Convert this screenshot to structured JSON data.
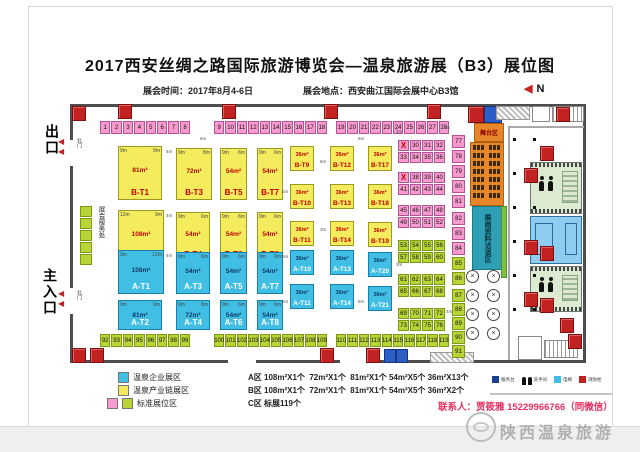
{
  "header": {
    "title": "2017西安丝绸之路国际旅游博览会—温泉旅游展（B3）展位图",
    "time_label": "展会时间：2017年8月4-6日",
    "place_label": "展会地点：西安曲江国际会展中心B3馆",
    "compass_n": "N"
  },
  "left": {
    "exit": "出口",
    "main_entrance": "主入口",
    "gate": "北门",
    "service_desk": "展会服务处"
  },
  "stage": {
    "label": "舞台区",
    "meeting_label": "展商资料洽谈区"
  },
  "booths": {
    "b_large": [
      {
        "name": "B-T1",
        "area": "81m²",
        "d1": "9m",
        "d2": "9m",
        "x": 118,
        "y": 146,
        "w": 44,
        "h": 54
      },
      {
        "name": "B-T3",
        "area": "72m²",
        "d1": "9m",
        "d2": "8m",
        "x": 176,
        "y": 148,
        "w": 36,
        "h": 52
      },
      {
        "name": "B-T5",
        "area": "54m²",
        "d1": "9m",
        "d2": "6m",
        "x": 220,
        "y": 148,
        "w": 27,
        "h": 52
      },
      {
        "name": "B-T7",
        "area": "54m²",
        "d1": "9m",
        "d2": "6m",
        "x": 257,
        "y": 148,
        "w": 26,
        "h": 52
      },
      {
        "name": "B-T2",
        "area": "108m²",
        "d1": "12m",
        "d2": "9m",
        "x": 118,
        "y": 210,
        "w": 46,
        "h": 54
      },
      {
        "name": "B-T4",
        "area": "54m²",
        "d1": "9m",
        "d2": "6m",
        "x": 176,
        "y": 212,
        "w": 34,
        "h": 50
      },
      {
        "name": "B-T6",
        "area": "54m²",
        "d1": "9m",
        "d2": "6m",
        "x": 220,
        "y": 212,
        "w": 27,
        "h": 50
      },
      {
        "name": "B-T8",
        "area": "54m²",
        "d1": "9m",
        "d2": "6m",
        "x": 257,
        "y": 212,
        "w": 26,
        "h": 50
      }
    ],
    "b_small": [
      {
        "name": "B-T9",
        "area": "36m²",
        "x": 290,
        "y": 146
      },
      {
        "name": "B-T12",
        "area": "36m²",
        "x": 330,
        "y": 146
      },
      {
        "name": "B-T17",
        "area": "36m²",
        "x": 368,
        "y": 146
      },
      {
        "name": "B-T10",
        "area": "36m²",
        "x": 290,
        "y": 184
      },
      {
        "name": "B-T13",
        "area": "36m²",
        "x": 330,
        "y": 184
      },
      {
        "name": "B-T18",
        "area": "36m²",
        "x": 368,
        "y": 184
      },
      {
        "name": "B-T11",
        "area": "36m²",
        "x": 290,
        "y": 221
      },
      {
        "name": "B-T14",
        "area": "36m²",
        "x": 330,
        "y": 221
      },
      {
        "name": "B-T19",
        "area": "36m²",
        "x": 368,
        "y": 222
      }
    ],
    "a_large": [
      {
        "name": "A-T1",
        "area": "108m²",
        "d1": "9m",
        "d2": "12m",
        "x": 118,
        "y": 250,
        "w": 46,
        "h": 44
      },
      {
        "name": "A-T3",
        "area": "54m²",
        "d1": "9m",
        "d2": "6m",
        "x": 176,
        "y": 252,
        "w": 34,
        "h": 42
      },
      {
        "name": "A-T5",
        "area": "54m²",
        "d1": "9m",
        "d2": "6m",
        "x": 220,
        "y": 252,
        "w": 27,
        "h": 42
      },
      {
        "name": "A-T7",
        "area": "54m²",
        "d1": "9m",
        "d2": "6m",
        "x": 257,
        "y": 252,
        "w": 26,
        "h": 42
      },
      {
        "name": "A-T2",
        "area": "81m²",
        "d1": "9m",
        "d2": "9m",
        "x": 118,
        "y": 300,
        "w": 44,
        "h": 30
      },
      {
        "name": "A-T4",
        "area": "72m²",
        "d1": "9m",
        "d2": "8m",
        "x": 176,
        "y": 300,
        "w": 34,
        "h": 30
      },
      {
        "name": "A-T6",
        "area": "54m²",
        "d1": "9m",
        "d2": "6m",
        "x": 220,
        "y": 300,
        "w": 27,
        "h": 30
      },
      {
        "name": "A-T8",
        "area": "54m²",
        "d1": "9m",
        "d2": "6m",
        "x": 257,
        "y": 300,
        "w": 26,
        "h": 30
      }
    ],
    "a_small": [
      {
        "name": "A-T10",
        "area": "36m²",
        "x": 290,
        "y": 250
      },
      {
        "name": "A-T13",
        "area": "36m²",
        "x": 330,
        "y": 250
      },
      {
        "name": "A-T20",
        "area": "36m²",
        "x": 368,
        "y": 252
      },
      {
        "name": "A-T11",
        "area": "36m²",
        "x": 290,
        "y": 284
      },
      {
        "name": "A-T14",
        "area": "36m²",
        "x": 330,
        "y": 284
      },
      {
        "name": "A-T21",
        "area": "36m²",
        "x": 368,
        "y": 286
      }
    ]
  },
  "std": {
    "top_groups": [
      {
        "start": 1,
        "count": 8,
        "x": 100
      },
      {
        "start": 9,
        "count": 10,
        "x": 214
      },
      {
        "start": 19,
        "count": 10,
        "x": 336
      }
    ],
    "bottom_groups": [
      {
        "start": 92,
        "count": 8,
        "x": 100
      },
      {
        "start": 100,
        "count": 10,
        "x": 214
      },
      {
        "start": 110,
        "count": 10,
        "x": 336
      }
    ],
    "grid": {
      "x": 398,
      "rows": [
        {
          "y": 140,
          "cells": [
            "X",
            "30",
            "31",
            "32"
          ]
        },
        {
          "y": 152,
          "cells": [
            "33",
            "34",
            "35",
            "36"
          ]
        },
        {
          "y": 172,
          "cells": [
            "X",
            "38",
            "39",
            "40"
          ]
        },
        {
          "y": 184,
          "cells": [
            "41",
            "42",
            "43",
            "44"
          ]
        },
        {
          "y": 205,
          "cells": [
            "45",
            "46",
            "47",
            "48"
          ]
        },
        {
          "y": 217,
          "cells": [
            "49",
            "50",
            "51",
            "52"
          ]
        },
        {
          "y": 240,
          "cells": [
            "53",
            "54",
            "55",
            "56"
          ],
          "g": true
        },
        {
          "y": 252,
          "cells": [
            "57",
            "58",
            "59",
            "60"
          ],
          "g": true
        },
        {
          "y": 274,
          "cells": [
            "61",
            "62",
            "63",
            "64"
          ],
          "g": true
        },
        {
          "y": 286,
          "cells": [
            "65",
            "66",
            "67",
            "68"
          ],
          "g": true
        },
        {
          "y": 308,
          "cells": [
            "69",
            "70",
            "71",
            "72"
          ],
          "g": true
        },
        {
          "y": 320,
          "cells": [
            "73",
            "74",
            "75",
            "76"
          ],
          "g": true
        }
      ]
    },
    "side_strip": [
      {
        "n": "77",
        "y": 135
      },
      {
        "n": "78",
        "y": 150
      },
      {
        "n": "79",
        "y": 165
      },
      {
        "n": "80",
        "y": 180
      },
      {
        "n": "81",
        "y": 195
      },
      {
        "n": "82",
        "y": 212
      },
      {
        "n": "83",
        "y": 227
      },
      {
        "n": "84",
        "y": 242
      },
      {
        "n": "85",
        "y": 257,
        "g": true
      },
      {
        "n": "86",
        "y": 272,
        "g": true
      },
      {
        "n": "87",
        "y": 289,
        "g": true
      },
      {
        "n": "88",
        "y": 303,
        "g": true
      },
      {
        "n": "89",
        "y": 317,
        "g": true
      },
      {
        "n": "90",
        "y": 331,
        "g": true
      },
      {
        "n": "91",
        "y": 345,
        "g": true
      }
    ]
  },
  "dims": [
    {
      "t": "4m",
      "x": 166,
      "y": 150
    },
    {
      "t": "4m",
      "x": 166,
      "y": 214
    },
    {
      "t": "4m",
      "x": 166,
      "y": 254
    },
    {
      "t": "6m",
      "x": 200,
      "y": 137
    },
    {
      "t": "6m",
      "x": 358,
      "y": 137
    },
    {
      "t": "5m",
      "x": 282,
      "y": 190
    },
    {
      "t": "5m",
      "x": 282,
      "y": 255
    },
    {
      "t": "5m",
      "x": 282,
      "y": 300
    },
    {
      "t": "5m",
      "x": 320,
      "y": 160
    },
    {
      "t": "3m",
      "x": 320,
      "y": 228
    },
    {
      "t": "5m",
      "x": 358,
      "y": 300
    },
    {
      "t": "3m",
      "x": 396,
      "y": 130
    },
    {
      "t": "3m",
      "x": 396,
      "y": 263
    },
    {
      "t": "1m",
      "x": 444,
      "y": 126
    },
    {
      "t": "4m",
      "x": 446,
      "y": 310
    }
  ],
  "legend": {
    "items": [
      {
        "color": "#41bee4",
        "label": "温泉企业展区"
      },
      {
        "color": "#f4ec5d",
        "label": "温泉产业链展区"
      },
      {
        "colors": [
          "#f79bcd",
          "#b8d437"
        ],
        "label": "标准展位区"
      }
    ],
    "zone_lines": [
      "A区 108m²X1个  72m²X1个  81m²X1个 54m²X5个 36m²X13个",
      "B区 108m²X1个  72m²X1个  81m²X1个 54m²X5个 36m²X2个",
      "C区 标展119个"
    ],
    "mini": [
      {
        "label": "服务台"
      },
      {
        "label": "洗手间"
      },
      {
        "label": "电梯"
      },
      {
        "label": "消防栓"
      }
    ]
  },
  "contact": "联系人：贾筱雅 15229966766（同微信）",
  "watermark": "陕西温泉旅游"
}
